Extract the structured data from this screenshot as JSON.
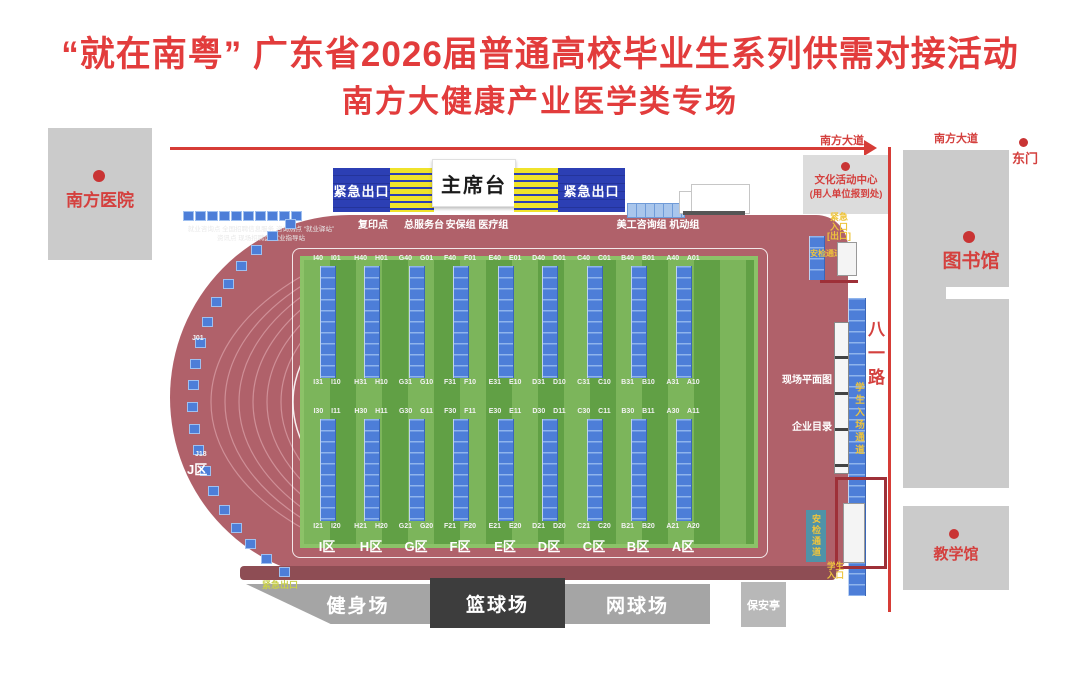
{
  "title": {
    "line1": "“就在南粤” 广东省2026届普通高校毕业生系列供需对接活动",
    "line2": "南方大健康产业医学类专场"
  },
  "colors": {
    "title_red": "#e23c3c",
    "track": "#b0616a",
    "field_light": "#7cb55b",
    "field_dark": "#61a045",
    "booth_blue": "#4d7ed8",
    "stand_blue": "#2c3fb4",
    "stripe_yellow": "#f0e32b",
    "road_red": "#d63c36",
    "building_gray": "#cbcbcb",
    "channel_yellow": "#eec43c"
  },
  "roads": {
    "top_road": "南方大道",
    "right_road": "南方大道",
    "vertical_road": "八一路",
    "east_gate": "东门"
  },
  "buildings": {
    "hospital": "南方医院",
    "culture_center_line1": "文化活动中心",
    "culture_center_line2": "(用人单位报到处)",
    "library": "图书馆",
    "teaching_hall": "教学馆",
    "security_booth": "保安亭"
  },
  "stage": {
    "rostrum": "主席台",
    "emergency_exit_left": "紧急出口",
    "emergency_exit_right": "紧急出口"
  },
  "service_points": {
    "copy_point": "复印点",
    "service_desk": "总服务台",
    "security_medical": "安保组 医疗组",
    "art_mobile": "美工咨询组 机动组"
  },
  "info_note": {
    "line1": "就业咨询点 全国招聘信息服务 咨询热点 “就业驿站”",
    "line2": "资讯点 现场招聘区 就业指导站"
  },
  "zones": [
    {
      "letter": "I",
      "top": "I40 I01",
      "mid_upper": "I31 I10",
      "mid_lower": "I30 I11",
      "bottom": "I21 I20",
      "name": "I区"
    },
    {
      "letter": "H",
      "top": "H40 H01",
      "mid_upper": "H31 H10",
      "mid_lower": "H30 H11",
      "bottom": "H21 H20",
      "name": "H区"
    },
    {
      "letter": "G",
      "top": "G40 G01",
      "mid_upper": "G31 G10",
      "mid_lower": "G30 G11",
      "bottom": "G21 G20",
      "name": "G区"
    },
    {
      "letter": "F",
      "top": "F40 F01",
      "mid_upper": "F31 F10",
      "mid_lower": "F30 F11",
      "bottom": "F21 F20",
      "name": "F区"
    },
    {
      "letter": "E",
      "top": "E40 E01",
      "mid_upper": "E31 E10",
      "mid_lower": "E30 E11",
      "bottom": "E21 E20",
      "name": "E区"
    },
    {
      "letter": "D",
      "top": "D40 D01",
      "mid_upper": "D31 D10",
      "mid_lower": "D30 D11",
      "bottom": "D21 D20",
      "name": "D区"
    },
    {
      "letter": "C",
      "top": "C40 C01",
      "mid_upper": "C31 C10",
      "mid_lower": "C30 C11",
      "bottom": "C21 C20",
      "name": "C区"
    },
    {
      "letter": "B",
      "top": "B40 B01",
      "mid_upper": "B31 B10",
      "mid_lower": "B30 B11",
      "bottom": "B21 B20",
      "name": "B区"
    },
    {
      "letter": "A",
      "top": "A40 A01",
      "mid_upper": "A31 A10",
      "mid_lower": "A30 A11",
      "bottom": "A21 A20",
      "name": "A区"
    }
  ],
  "j_zone": {
    "first_label": "J01",
    "last_label": "J18",
    "name": "J区",
    "booth_count": 20
  },
  "top_booth_row_count": 10,
  "right_side": {
    "site_map": "现场平面图",
    "company_directory": "企业目录",
    "student_channel": "学生入场通道",
    "security_check_top": "安检通道",
    "security_check_bottom": "安检通道",
    "emergency_entrance_line1": "紧急",
    "emergency_entrance_line2": "入口",
    "emergency_entrance_line3": "[出口]",
    "student_entrance_line1": "学生",
    "student_entrance_line2": "入口"
  },
  "bottom": {
    "emergency_exit": "紧急出口",
    "fitness": "健身场",
    "basketball": "篮球场",
    "tennis": "网球场"
  }
}
